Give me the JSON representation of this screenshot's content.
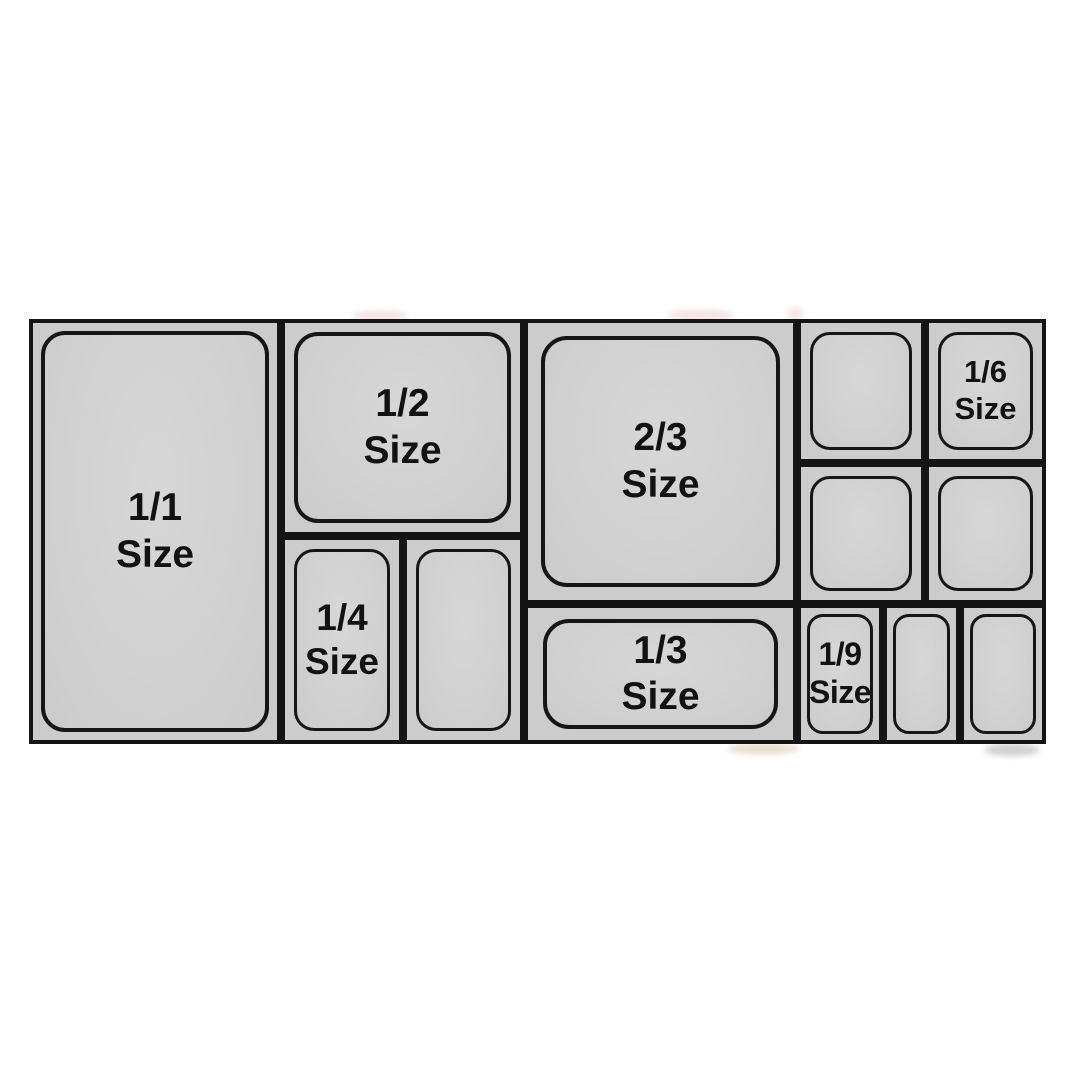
{
  "labels": {
    "full": {
      "fraction": "1/1",
      "word": "Size"
    },
    "half": {
      "fraction": "1/2",
      "word": "Size"
    },
    "two_thirds": {
      "fraction": "2/3",
      "word": "Size"
    },
    "third": {
      "fraction": "1/3",
      "word": "Size"
    },
    "quarter": {
      "fraction": "1/4",
      "word": "Size"
    },
    "sixth": {
      "fraction": "1/6",
      "word": "Size"
    },
    "ninth": {
      "fraction": "1/9",
      "word": "Size"
    }
  },
  "colors": {
    "pan_fill": "#d1d1d1",
    "pan_outline": "#141414",
    "label_text": "#121212",
    "page_background": "#ffffff"
  }
}
